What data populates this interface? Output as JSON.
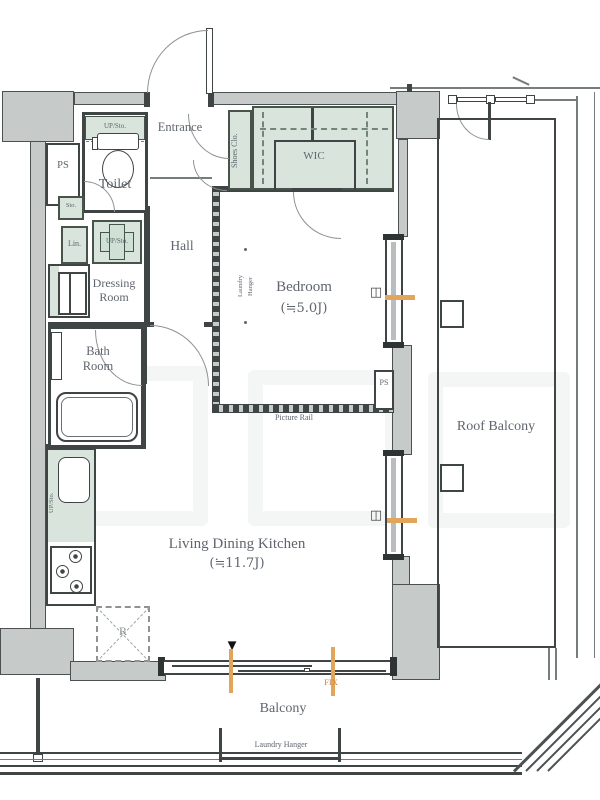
{
  "title": "apartment-floor-plan",
  "labels": {
    "entrance": "Entrance",
    "shoes_closet": "Shoes Clo.",
    "wic": "WIC",
    "toilet": "Toilet",
    "ps": "PS",
    "sto": "Sto.",
    "lin": "Lin.",
    "up_sto": "UP/Sto.",
    "dressing_room": "Dressing Room",
    "hall": "Hall",
    "bedroom": "Bedroom",
    "bedroom_size": "(≒5.0J)",
    "laundry": "Laundry",
    "hanger": "Hanger",
    "picture_rail": "Picture Rail",
    "bath_room": "Bath Room",
    "ldk": "Living Dining Kitchen",
    "ldk_size": "(≒11.7J)",
    "refrigerator": "R",
    "fix": "FIX",
    "roof_balcony": "Roof Balcony",
    "balcony": "Balcony",
    "laundry_hanger": "Laundry Hanger"
  },
  "colors": {
    "wall_fill": "#c6cac9",
    "wall_line": "#3f4445",
    "storage_fill": "#d9e5dc",
    "storage_line": "#46544a",
    "text": "#5f656e",
    "window_marker_orange": "#e2a55c",
    "fix_text": "#c8833c"
  }
}
